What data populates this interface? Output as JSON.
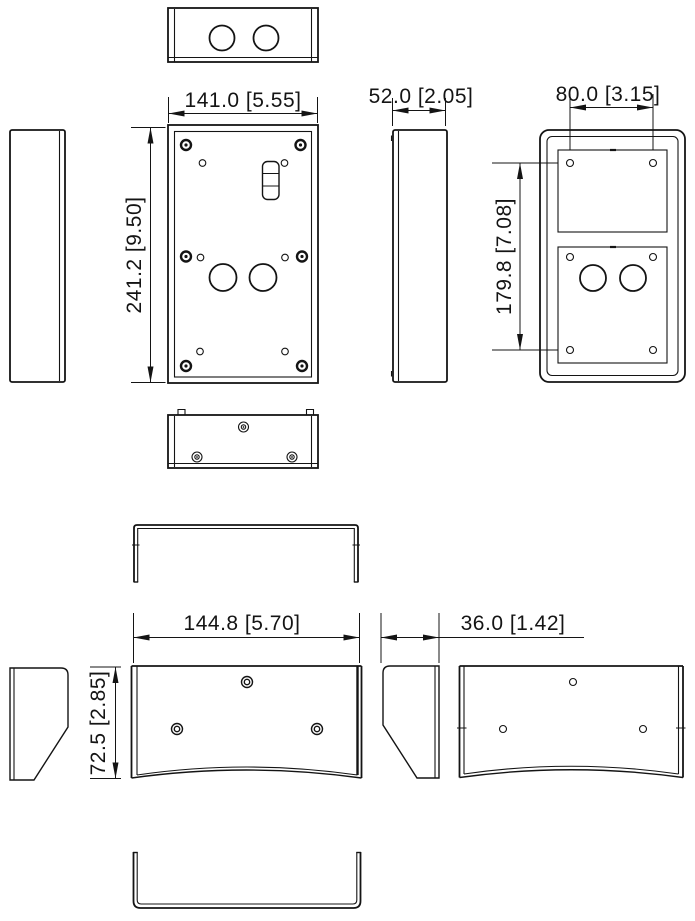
{
  "drawing": {
    "type": "technical-dimension-drawing",
    "background": "#ffffff",
    "line_color": "#141414",
    "units": "mm [in]",
    "dimensions": {
      "box_width": "141.0  [5.55]",
      "box_depth": "52.0  [2.05]",
      "hole_spacing_width": "80.0  [3.15]",
      "box_height": "241.2  [9.50]",
      "hole_spacing_height": "179.8  [7.08]",
      "hood_width": "144.8  [5.70]",
      "hood_depth": "36.0  [1.42]",
      "hood_height": "72.5  [2.85]"
    }
  }
}
